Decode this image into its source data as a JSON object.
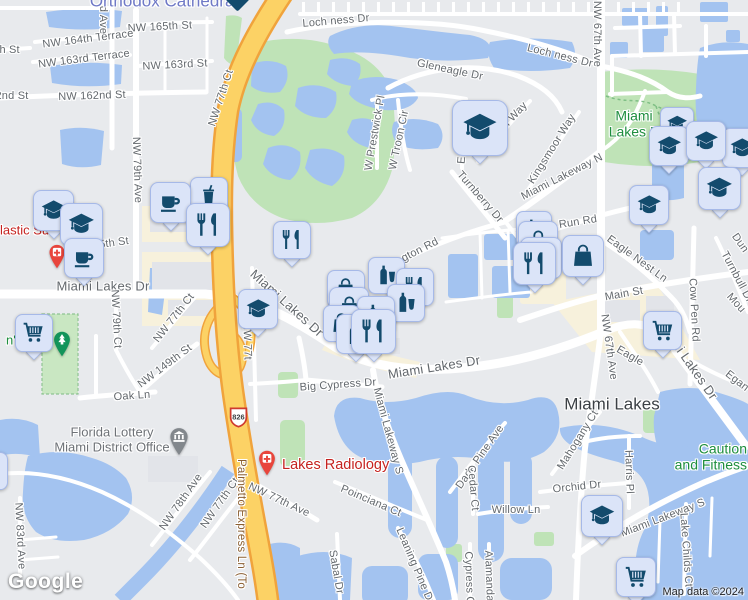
{
  "map": {
    "logo_text": "Google",
    "attribution": "Map data ©2024",
    "route_shield": {
      "text": "826"
    },
    "area_labels": [
      {
        "name": "orthodox-cathedral-label",
        "lines": [
          "Orthodox Cathedral"
        ],
        "x": 164,
        "y": 1,
        "size": 17,
        "color": "#6f79c6",
        "align": "center"
      },
      {
        "name": "miami-lakes-park-label",
        "lines": [
          "Miami",
          "Lakes P"
        ],
        "x": 634,
        "y": 124,
        "size": 14,
        "color": "#1e8e3e",
        "align": "center"
      },
      {
        "name": "caution-and-fitness-label",
        "lines": [
          "Caution",
          "and Fitness"
        ],
        "x": 747,
        "y": 457,
        "size": 14,
        "color": "#1e8e3e",
        "align": "right"
      },
      {
        "name": "park-name-partial-label",
        "lines": [
          "n's"
        ],
        "x": 6,
        "y": 341,
        "size": 13,
        "color": "#1e8e3e",
        "align": "left"
      },
      {
        "name": "locality-label",
        "lines": [
          "Miami Lakes"
        ],
        "x": 612,
        "y": 404,
        "size": 17,
        "color": "#3b4045",
        "align": "center"
      }
    ],
    "poi_labels": [
      {
        "name": "plastic-surgery-label",
        "lines": [
          "lastic Su"
        ],
        "x": 0,
        "y": 231,
        "size": 13,
        "color": "#c5221f",
        "align": "left"
      },
      {
        "name": "lakes-radiology-label",
        "lines": [
          "Lakes Radiology"
        ],
        "x": 282,
        "y": 465,
        "size": 14.5,
        "color": "#c5221f",
        "align": "left"
      },
      {
        "name": "florida-lottery-label",
        "lines": [
          "Florida Lottery",
          "Miami District Office"
        ],
        "x": 112,
        "y": 440,
        "size": 13,
        "color": "#6e7277",
        "align": "center"
      }
    ],
    "street_labels": [
      {
        "text": "NW 165th St",
        "x": 160,
        "y": 27,
        "r": -3
      },
      {
        "text": "NW 164th Terrace",
        "x": 88,
        "y": 39,
        "r": -7
      },
      {
        "text": "NW 163rd Terrace",
        "x": 84,
        "y": 59,
        "r": -7
      },
      {
        "text": "NW 163rd St",
        "x": 175,
        "y": 65,
        "r": -3
      },
      {
        "text": "NW 162nd St",
        "x": 92,
        "y": 96,
        "r": -2
      },
      {
        "text": "2nd St",
        "x": 12,
        "y": 96,
        "r": 0
      },
      {
        "text": "th St",
        "x": 8,
        "y": 50,
        "r": 0
      },
      {
        "text": "d Ave",
        "x": 103,
        "y": 20,
        "r": 90
      },
      {
        "text": "NW 77th Ct",
        "x": 221,
        "y": 98,
        "r": -72
      },
      {
        "text": "NW 67th Ave",
        "x": 597,
        "y": 34,
        "r": 90
      },
      {
        "text": "Loch ness Dr",
        "x": 336,
        "y": 21,
        "r": -5
      },
      {
        "text": "Loch ness Dr",
        "x": 560,
        "y": 56,
        "r": 14
      },
      {
        "text": "Gleneagle Dr",
        "x": 450,
        "y": 70,
        "r": 12
      },
      {
        "text": "W Prestwick Pl",
        "x": 375,
        "y": 133,
        "r": -80
      },
      {
        "text": "W Troon Cir",
        "x": 399,
        "y": 140,
        "r": -78
      },
      {
        "text": "E Troon Cir",
        "x": 464,
        "y": 135,
        "r": -85
      },
      {
        "text": "Aberdeen Way",
        "x": 500,
        "y": 131,
        "r": -47
      },
      {
        "text": "Kingsmoor Way",
        "x": 552,
        "y": 149,
        "r": -58
      },
      {
        "text": "Miami Lakeway N",
        "x": 562,
        "y": 177,
        "r": -27
      },
      {
        "text": "Turnberry Dr",
        "x": 480,
        "y": 197,
        "r": 49
      },
      {
        "text": "gton Rd",
        "x": 420,
        "y": 250,
        "r": -27
      },
      {
        "text": "Run Rd",
        "x": 578,
        "y": 222,
        "r": -9
      },
      {
        "text": "Eagle Nest Ln",
        "x": 637,
        "y": 259,
        "r": 36
      },
      {
        "text": "Main St",
        "x": 624,
        "y": 294,
        "r": -10
      },
      {
        "text": "Cow Pen Rd",
        "x": 694,
        "y": 310,
        "r": 87
      },
      {
        "text": "Turnbull Dr",
        "x": 737,
        "y": 277,
        "r": 62
      },
      {
        "text": "Mou",
        "x": 736,
        "y": 303,
        "r": 48
      },
      {
        "text": "Egan",
        "x": 737,
        "y": 381,
        "r": 38
      },
      {
        "text": "Dun",
        "x": 740,
        "y": 243,
        "r": 55
      },
      {
        "text": "Eagle",
        "x": 630,
        "y": 356,
        "r": 30
      },
      {
        "text": "Miami Lakes Dr",
        "x": 103,
        "y": 286,
        "r": 0,
        "size": 13
      },
      {
        "text": "Miami Lakes Dr",
        "x": 287,
        "y": 303,
        "r": 42,
        "size": 13
      },
      {
        "text": "Miami Lakes Dr",
        "x": 434,
        "y": 367,
        "r": -9,
        "size": 13
      },
      {
        "text": "Miami Lakes Dr",
        "x": 688,
        "y": 360,
        "r": 55,
        "size": 13
      },
      {
        "text": "NW 79th Ave",
        "x": 137,
        "y": 170,
        "r": 88
      },
      {
        "text": "5th St",
        "x": 114,
        "y": 243,
        "r": -8
      },
      {
        "text": "NW 79th Ct",
        "x": 116,
        "y": 319,
        "r": 87
      },
      {
        "text": "NW 77th Ct",
        "x": 174,
        "y": 318,
        "r": -52
      },
      {
        "text": "NW 149th St",
        "x": 165,
        "y": 366,
        "r": -37
      },
      {
        "text": "Oak Ln",
        "x": 132,
        "y": 396,
        "r": -4
      },
      {
        "text": "NW 77th Ct",
        "x": 220,
        "y": 503,
        "r": -55
      },
      {
        "text": "NW 78th Ave",
        "x": 181,
        "y": 502,
        "r": -55
      },
      {
        "text": "NW 83rd Ave",
        "x": 20,
        "y": 536,
        "r": 87
      },
      {
        "text": "NW 77th Ave",
        "x": 279,
        "y": 500,
        "r": 25
      },
      {
        "text": "Poinciana Ct",
        "x": 371,
        "y": 501,
        "r": 23
      },
      {
        "text": "Sabal Dr",
        "x": 336,
        "y": 572,
        "r": 80
      },
      {
        "text": "Miami Lakeway S",
        "x": 388,
        "y": 431,
        "r": 75
      },
      {
        "text": "Big Cypress Dr",
        "x": 338,
        "y": 385,
        "r": -4
      },
      {
        "text": "Dade Pine Ave",
        "x": 480,
        "y": 457,
        "r": -55
      },
      {
        "text": "Cedar Ct",
        "x": 473,
        "y": 488,
        "r": 85
      },
      {
        "text": "Willow Ln",
        "x": 516,
        "y": 510,
        "r": 0
      },
      {
        "text": "Orchid Dr",
        "x": 577,
        "y": 487,
        "r": -6
      },
      {
        "text": "Mahogany Ct",
        "x": 578,
        "y": 440,
        "r": -58
      },
      {
        "text": "Harris Pl",
        "x": 629,
        "y": 472,
        "r": 88
      },
      {
        "text": "Miami Lakeway S",
        "x": 663,
        "y": 518,
        "r": -21
      },
      {
        "text": "Lake Childs Ct",
        "x": 686,
        "y": 550,
        "r": 86
      },
      {
        "text": "Leaning Pine Dr",
        "x": 415,
        "y": 566,
        "r": 67
      },
      {
        "text": "Cypress C",
        "x": 469,
        "y": 578,
        "r": 88
      },
      {
        "text": "Alamanda",
        "x": 489,
        "y": 576,
        "r": 88
      },
      {
        "text": "NW 67th Ave",
        "x": 609,
        "y": 347,
        "r": 82
      },
      {
        "text": "NW 77t",
        "x": 247,
        "y": 341,
        "r": 88
      },
      {
        "text": "Palmetto Express Ln (To",
        "x": 241,
        "y": 524,
        "r": 90,
        "size": 11.5,
        "color": "#8a5f33"
      }
    ],
    "markers": [
      {
        "name": "school-marker",
        "icon": "graduation-cap-icon",
        "x": 660,
        "y": 107,
        "s": 34,
        "pointer": false
      },
      {
        "name": "school-marker",
        "icon": "graduation-cap-icon",
        "x": 722,
        "y": 128,
        "s": 40,
        "pointer": true
      },
      {
        "name": "school-marker",
        "icon": "graduation-cap-icon",
        "x": 649,
        "y": 126,
        "s": 40,
        "pointer": true
      },
      {
        "name": "school-marker",
        "icon": "graduation-cap-icon",
        "x": 686,
        "y": 121,
        "s": 40,
        "pointer": true
      },
      {
        "name": "school-marker",
        "icon": "graduation-cap-icon",
        "x": 698,
        "y": 167,
        "s": 43,
        "pointer": true
      },
      {
        "name": "school-marker",
        "icon": "graduation-cap-icon",
        "x": 629,
        "y": 185,
        "s": 40,
        "pointer": true
      },
      {
        "name": "school-marker",
        "icon": "graduation-cap-icon",
        "x": 452,
        "y": 100,
        "s": 56,
        "pointer": true
      },
      {
        "name": "fast-food-marker",
        "icon": "soda-cup-icon",
        "x": 190,
        "y": 177,
        "s": 38,
        "pointer": false
      },
      {
        "name": "cafe-marker",
        "icon": "coffee-cup-icon",
        "x": 150,
        "y": 182,
        "s": 41,
        "pointer": true
      },
      {
        "name": "restaurant-marker",
        "icon": "fork-knife-icon",
        "x": 186,
        "y": 203,
        "s": 44,
        "pointer": true
      },
      {
        "name": "school-marker",
        "icon": "graduation-cap-icon",
        "x": 33,
        "y": 190,
        "s": 41,
        "pointer": true
      },
      {
        "name": "school-marker",
        "icon": "graduation-cap-icon",
        "x": 60,
        "y": 203,
        "s": 43,
        "pointer": true
      },
      {
        "name": "cafe-marker",
        "icon": "coffee-cup-icon",
        "x": 64,
        "y": 238,
        "s": 40,
        "pointer": true
      },
      {
        "name": "restaurant-marker",
        "icon": "fork-knife-icon",
        "x": 273,
        "y": 221,
        "s": 38,
        "pointer": true
      },
      {
        "name": "school-marker",
        "icon": "graduation-cap-icon",
        "x": 238,
        "y": 289,
        "s": 40,
        "pointer": true
      },
      {
        "name": "food-drink-marker",
        "icon": "bottle-glass-icon",
        "x": 368,
        "y": 257,
        "s": 37,
        "pointer": false
      },
      {
        "name": "restaurant-marker",
        "icon": "fork-knife-icon",
        "x": 396,
        "y": 268,
        "s": 38,
        "pointer": false
      },
      {
        "name": "store-marker",
        "icon": "shopping-bag-icon",
        "x": 327,
        "y": 270,
        "s": 38,
        "pointer": false
      },
      {
        "name": "food-drink-marker",
        "icon": "bottle-glass-icon",
        "x": 387,
        "y": 284,
        "s": 38,
        "pointer": false
      },
      {
        "name": "store-marker",
        "icon": "shopping-bag-icon",
        "x": 329,
        "y": 287,
        "s": 40,
        "pointer": false
      },
      {
        "name": "food-drink-marker",
        "icon": "bottle-glass-icon",
        "x": 357,
        "y": 296,
        "s": 38,
        "pointer": false
      },
      {
        "name": "store-marker",
        "icon": "shopping-bag-icon",
        "x": 323,
        "y": 305,
        "s": 37,
        "pointer": false
      },
      {
        "name": "food-drink-marker",
        "icon": "bottle-glass-icon",
        "x": 336,
        "y": 314,
        "s": 40,
        "pointer": true
      },
      {
        "name": "restaurant-marker",
        "icon": "fork-knife-icon",
        "x": 351,
        "y": 309,
        "s": 45,
        "pointer": true
      },
      {
        "name": "food-drink-marker",
        "icon": "bottle-glass-icon",
        "x": 516,
        "y": 211,
        "s": 36,
        "pointer": false
      },
      {
        "name": "store-marker",
        "icon": "shopping-bag-icon",
        "x": 518,
        "y": 221,
        "s": 40,
        "pointer": false
      },
      {
        "name": "food-drink-marker",
        "icon": "bottle-glass-icon",
        "x": 520,
        "y": 237,
        "s": 42,
        "pointer": false
      },
      {
        "name": "store-marker",
        "icon": "shopping-bag-icon",
        "x": 562,
        "y": 235,
        "s": 42,
        "pointer": true
      },
      {
        "name": "restaurant-marker",
        "icon": "fork-knife-icon",
        "x": 513,
        "y": 242,
        "s": 43,
        "pointer": true
      },
      {
        "name": "supermarket-marker",
        "icon": "shopping-cart-icon",
        "x": 15,
        "y": 314,
        "s": 38,
        "pointer": true
      },
      {
        "name": "supermarket-marker",
        "icon": "shopping-cart-icon",
        "x": 643,
        "y": 311,
        "s": 39,
        "pointer": true
      },
      {
        "name": "supermarket-marker",
        "icon": "shopping-cart-icon",
        "x": 616,
        "y": 557,
        "s": 40,
        "pointer": true
      },
      {
        "name": "school-marker",
        "icon": "graduation-cap-icon",
        "x": 581,
        "y": 495,
        "s": 42,
        "pointer": true
      },
      {
        "name": "restaurant-marker",
        "icon": "fork-knife-icon",
        "x": -30,
        "y": 452,
        "s": 38,
        "pointer": true
      }
    ],
    "pins": [
      {
        "name": "medical-pin",
        "icon": "medical-cross-icon",
        "x": 57,
        "y": 270,
        "w": 20,
        "color": "#e8453c"
      },
      {
        "name": "radiology-pin",
        "icon": "medical-cross-icon",
        "x": 267,
        "y": 477,
        "w": 21,
        "color": "#e8453c"
      },
      {
        "name": "park-pin",
        "icon": "pine-tree-icon",
        "x": 62,
        "y": 358,
        "w": 21,
        "color": "#12945a"
      },
      {
        "name": "museum-pin",
        "icon": "museum-icon",
        "x": 179,
        "y": 457,
        "w": 23,
        "color": "#82878c"
      }
    ]
  },
  "colors": {
    "land": "#e8eaed",
    "water": "#a3c3f0",
    "park": "#bfe3b7",
    "commercial": "#f7f1dc",
    "road": "#ffffff",
    "highway": "#fcd265",
    "highway-casing": "#f0a33c",
    "marker-bg": "#dbe4f8",
    "marker-border": "#a6b9e8",
    "marker-glyph": "#134b6d",
    "street-label": "#63686d",
    "red-poi": "#c5221f",
    "green-poi": "#1e8e3e",
    "pin-red": "#e8453c",
    "pin-green": "#12945a",
    "pin-gray": "#82878c",
    "shield-border": "#cf3a2f",
    "toll-label": "#8a5f33",
    "locality": "#3b4045",
    "cathedral-blue": "#6f79c6"
  }
}
